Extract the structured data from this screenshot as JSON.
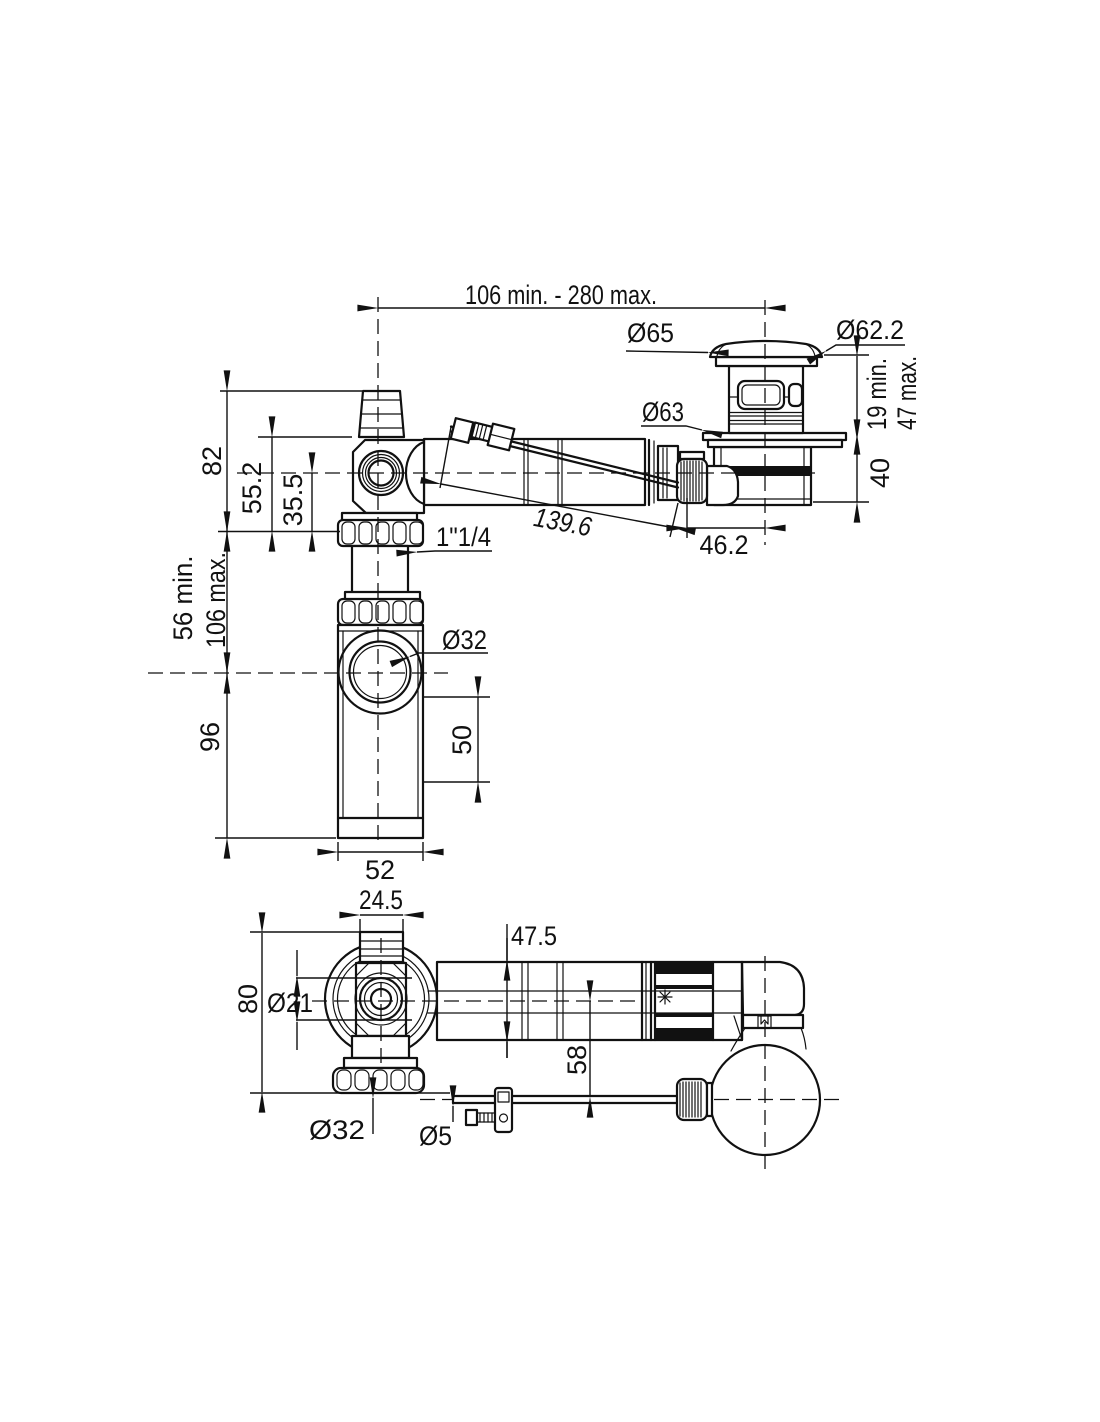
{
  "drawing": {
    "type": "technical-dimension-drawing",
    "subject": "sink pop-up waste with space-saving bottle trap",
    "ink_color": "#111111",
    "background_color": "#ffffff"
  },
  "side_view": {
    "dims": {
      "span": "106 min. - 280 max.",
      "cap_dia": "Ø65",
      "plug_dia": "Ø62.2",
      "waste_dia": "Ø63",
      "inlet_height": "82",
      "tee_height": "55.2",
      "center_height": "35.5",
      "trap_range_min": "56 min.",
      "trap_range_max": "106 max.",
      "thread": "1\"1/4",
      "rod_length": "139.6",
      "waste_offset": "46.2",
      "plug_travel_min": "19 min.",
      "plug_travel_max": "47 max.",
      "waste_body_height": "40",
      "trap_dia": "Ø32",
      "outlet_drop": "50",
      "cup_height": "96",
      "cup_width": "52"
    }
  },
  "bottom_view": {
    "dims": {
      "barb_width": "24.5",
      "pipe_dia": "47.5",
      "overall_depth": "80",
      "inlet_bore_dia": "Ø21",
      "rod_offset": "58",
      "nut_dia": "Ø32",
      "rod_dia": "Ø5"
    }
  }
}
